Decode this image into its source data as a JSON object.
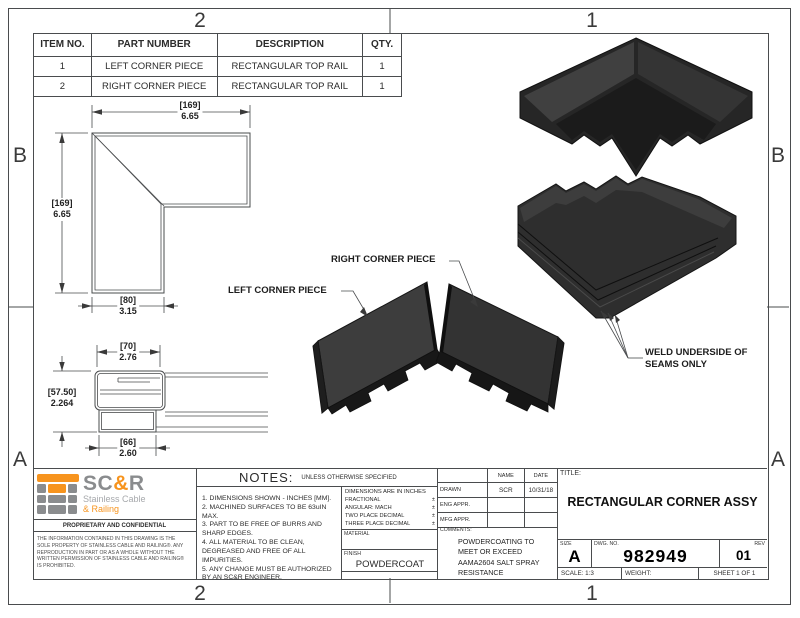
{
  "frame": {
    "zone_top_left": "2",
    "zone_top_right": "1",
    "zone_bottom_left": "2",
    "zone_bottom_right": "1",
    "zone_left_top": "B",
    "zone_left_bottom": "A",
    "zone_right_top": "B",
    "zone_right_bottom": "A"
  },
  "bom": {
    "headers": {
      "item": "ITEM NO.",
      "part": "PART NUMBER",
      "desc": "DESCRIPTION",
      "qty": "QTY."
    },
    "rows": [
      {
        "item": "1",
        "part": "LEFT CORNER PIECE",
        "desc": "RECTANGULAR TOP RAIL",
        "qty": "1"
      },
      {
        "item": "2",
        "part": "RIGHT CORNER PIECE",
        "desc": "RECTANGULAR TOP RAIL",
        "qty": "1"
      }
    ]
  },
  "plan_view": {
    "dim_top_mm": "[169]",
    "dim_top_in": "6.65",
    "dim_left_mm": "[169]",
    "dim_left_in": "6.65",
    "dim_bottom_mm": "[80]",
    "dim_bottom_in": "3.15"
  },
  "section_view": {
    "dim_top_mm": "[70]",
    "dim_top_in": "2.76",
    "dim_left_mm": "[57.50]",
    "dim_left_in": "2.264",
    "dim_bottom_mm": "[66]",
    "dim_bottom_in": "2.60"
  },
  "callouts": {
    "left_piece": "LEFT CORNER PIECE",
    "right_piece": "RIGHT CORNER PIECE",
    "weld_note": "WELD UNDERSIDE OF SEAMS ONLY"
  },
  "logo": {
    "name_sc": "SC",
    "name_amp": "&",
    "name_r": "R",
    "sub_line1": "Stainless Cable",
    "sub_line2": "& Railing",
    "orange": "#F7941E",
    "gray": "#8A8C8E",
    "light_gray": "#A7A9AC"
  },
  "proprietary": {
    "heading": "PROPRIETARY AND CONFIDENTIAL",
    "body": "THE INFORMATION CONTAINED IN THIS DRAWING IS THE SOLE PROPERTY OF STAINLESS CABLE AND RAILING®. ANY REPRODUCTION IN PART OR AS A WHOLE WITHOUT THE WRITTEN PERMISSION OF STAINLESS CABLE AND RAILING® IS PROHIBITED."
  },
  "notes": {
    "heading": "NOTES:",
    "subheading": "UNLESS OTHERWISE SPECIFIED",
    "items": [
      "1. DIMENSIONS SHOWN - INCHES [MM].",
      "2. MACHINED SURFACES TO BE 63uIN MAX.",
      "3. PART TO BE FREE OF BURRS AND SHARP EDGES.",
      "4. ALL MATERIAL TO BE CLEAN, DEGREASED AND FREE OF ALL IMPURITIES.",
      "5. ANY CHANGE MUST BE AUTHORIZED BY AN SC&R ENGINEER."
    ]
  },
  "tolerances": {
    "title": "DIMENSIONS ARE IN INCHES",
    "rows": [
      {
        "label": "FRACTIONAL",
        "value": "±"
      },
      {
        "label": "ANGULAR: MACH",
        "value": "±"
      },
      {
        "label": "TWO PLACE DECIMAL",
        "value": "±"
      },
      {
        "label": "THREE PLACE DECIMAL",
        "value": "±"
      }
    ],
    "material_label": "MATERIAL",
    "finish_label": "FINISH",
    "finish_value": "POWDERCOAT"
  },
  "approvals": {
    "name_header": "NAME",
    "date_header": "DATE",
    "rows": [
      {
        "label": "DRAWN",
        "name": "SCR",
        "date": "10/31/18"
      },
      {
        "label": "ENG APPR.",
        "name": "",
        "date": ""
      },
      {
        "label": "MFG APPR.",
        "name": "",
        "date": ""
      }
    ],
    "comments_label": "COMMENTS:",
    "comments": "POWDERCOATING TO MEET OR EXCEED AAMA2604 SALT SPRAY RESISTANCE"
  },
  "title_block": {
    "title_label": "TITLE:",
    "title": "RECTANGULAR CORNER ASSY",
    "size_label": "SIZE",
    "size": "A",
    "dwg_label": "DWG.  NO.",
    "dwg_no": "982949",
    "rev_label": "REV",
    "rev": "01",
    "scale": "SCALE: 1:3",
    "weight": "WEIGHT:",
    "sheet": "SHEET 1 OF 1"
  }
}
